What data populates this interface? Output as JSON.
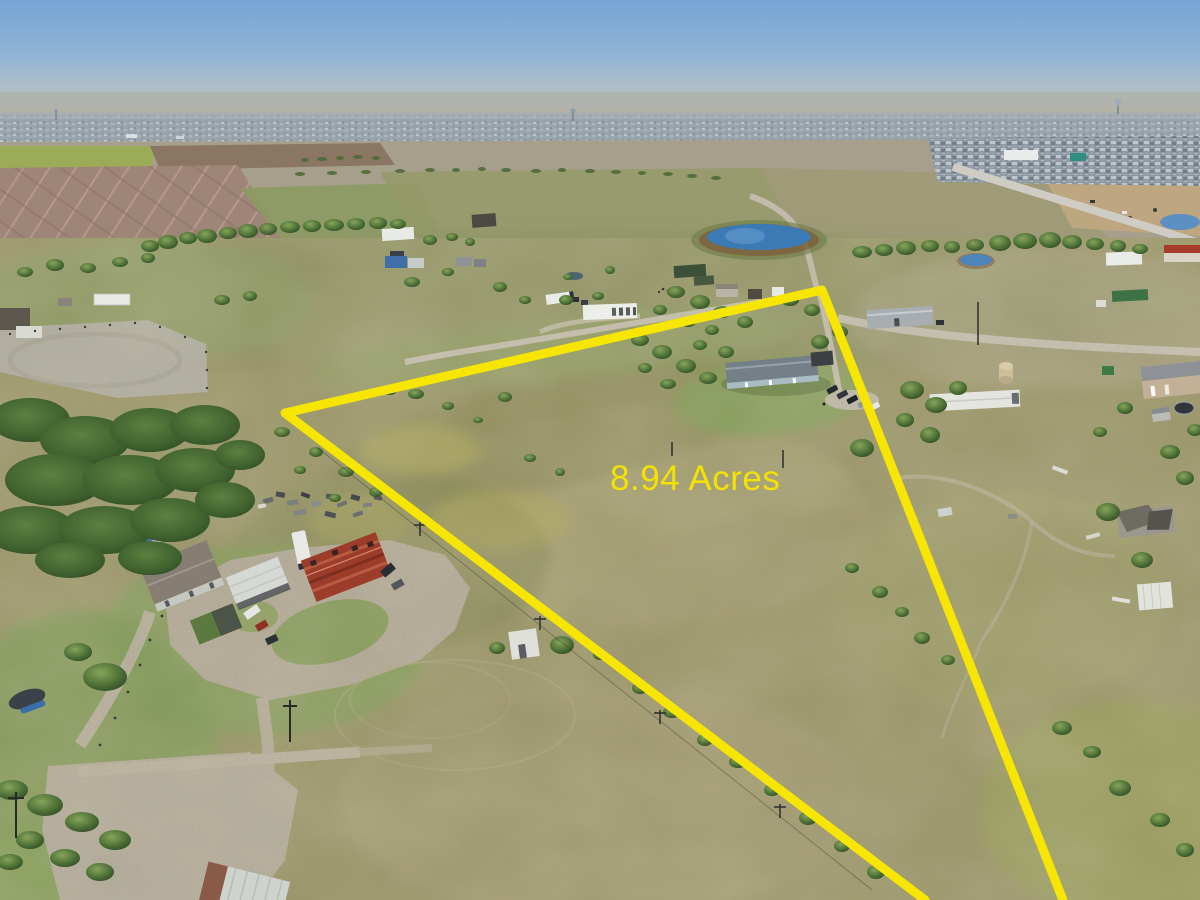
{
  "photo": {
    "type": "aerial-drone-photo-of-rural-property",
    "caption_overlay": {
      "acreage_label": "8.94 Acres",
      "label_color": "#f4e202",
      "boundary_color": "#f7e602"
    },
    "key_colors": {
      "sky_top": "#78a5d3",
      "horizon_haze": "#b9bcb4",
      "distant_city": "#9aa4ad",
      "field_olive": "#9a9567",
      "grass_green": "#7f9e56",
      "plowed_field_mauve": "#9f8478",
      "dirt_road": "#b6aea0",
      "pond_blue": "#3c7ab6",
      "tree_green": "#4f6a3a"
    }
  }
}
